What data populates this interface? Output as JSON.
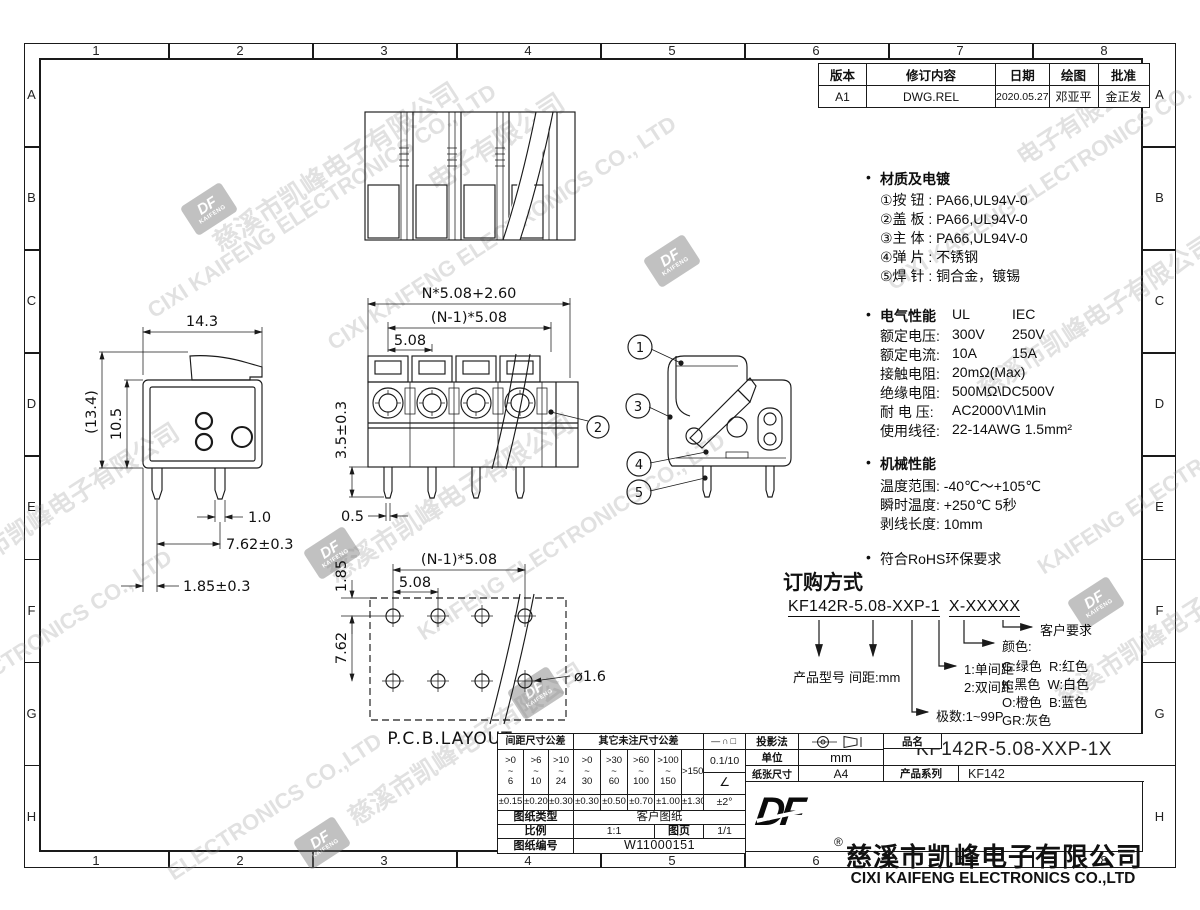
{
  "frame": {
    "col_labels": [
      "1",
      "2",
      "3",
      "4",
      "5",
      "6",
      "7",
      "8"
    ],
    "row_labels": [
      "A",
      "B",
      "C",
      "D",
      "E",
      "F",
      "G",
      "H"
    ]
  },
  "revision_table": {
    "headers": [
      "版本",
      "修订内容",
      "日期",
      "绘图",
      "批准"
    ],
    "row": [
      "A1",
      "DWG.REL",
      "2020.05.27",
      "邓亚平",
      "金正发"
    ]
  },
  "specs": {
    "bullet": "•",
    "materials": {
      "title": "材质及电镀",
      "items": [
        "①按 钮 : PA66,UL94V-0",
        "②盖 板 : PA66,UL94V-0",
        "③主 体 : PA66,UL94V-0",
        "④弹 片 : 不锈钢",
        "⑤焊 针 : 铜合金，镀锡"
      ]
    },
    "electrical": {
      "title": "电气性能",
      "col1": "UL",
      "col2": "IEC",
      "rows": [
        {
          "label": "额定电压:",
          "a": "300V",
          "b": "250V"
        },
        {
          "label": "额定电流:",
          "a": "10A",
          "b": "15A"
        },
        {
          "label": "接触电阻:",
          "a": "20mΩ(Max)",
          "b": ""
        },
        {
          "label": "绝缘电阻:",
          "a": "500MΩ\\DC500V",
          "b": ""
        },
        {
          "label": "耐 电 压:",
          "a": "AC2000V\\1Min",
          "b": ""
        },
        {
          "label": "使用线径:",
          "a": "22-14AWG 1.5mm²",
          "b": ""
        }
      ]
    },
    "mechanical": {
      "title": "机械性能",
      "items": [
        "温度范围: -40℃～+105℃",
        "瞬时温度: +250℃ 5秒",
        "剥线长度: 10mm"
      ]
    },
    "rohs": "符合RoHS环保要求"
  },
  "ordering": {
    "title": "订购方式",
    "code_left": "KF142R-5.08-XXP-1",
    "code_right": "X-XXXXX",
    "labels": {
      "model": "产品型号",
      "pitch": "间距:mm",
      "poles": "极数:1~99P",
      "row1": "1:单间距",
      "row2": "2:双间距",
      "color_title": "颜色:",
      "colors": [
        "G:绿色  R:红色",
        "K:黑色  W:白色",
        "O:橙色  B:蓝色",
        "GR:灰色"
      ],
      "customer": "客户要求"
    }
  },
  "views": {
    "side": {
      "dims": {
        "width": "14.3",
        "overall_height": "(13.4)",
        "body_height": "10.5",
        "pin_width": "1.0",
        "pin_pitch": "7.62±0.3",
        "pin_offset": "1.85±0.3"
      }
    },
    "front": {
      "dims": {
        "total": "N*5.08+2.60",
        "span": "(N-1)*5.08",
        "pitch": "5.08",
        "pin_len": "3.5±0.3",
        "pin_thk": "0.5"
      },
      "callout": "2"
    },
    "section": {
      "callouts": [
        "1",
        "3",
        "4",
        "5"
      ]
    },
    "pcb": {
      "dims": {
        "span": "(N-1)*5.08",
        "pitch": "5.08",
        "edge": "1.85",
        "row": "7.62",
        "hole": "ø1.6"
      },
      "label": "P.C.B.LAYOUT"
    }
  },
  "tol_table": {
    "pitch_header": "间距尺寸公差",
    "other_header": "其它未注尺寸公差",
    "pitch_ranges": [
      ">0\n~\n6",
      ">6\n~\n10",
      ">10\n~\n24"
    ],
    "other_ranges": [
      ">0\n~\n30",
      ">30\n~\n60",
      ">60\n~\n100",
      ">100\n~\n150"
    ],
    "last_range": ">150",
    "pitch_tols": [
      "±0.15",
      "±0.20",
      "±0.30"
    ],
    "other_tols": [
      "±0.30",
      "±0.50",
      "±0.70",
      "±1.00"
    ],
    "last_tol": "±1.30",
    "geo_symbols": "—∩□",
    "flat_tol": "0.1/10",
    "angle_symbol": "∠",
    "angle_tol": "±2°",
    "doc_type_label": "图纸类型",
    "doc_type": "客户图纸",
    "scale_label": "比例",
    "scale": "1:1",
    "page_label": "图页",
    "page": "1/1",
    "number_label": "图纸编号",
    "number": "W11000151"
  },
  "title_block": {
    "projection_label": "投影法",
    "unit_label": "单位",
    "unit": "mm",
    "paper_label": "纸张尺寸",
    "paper": "A4",
    "name_label": "品名",
    "part_number": "KF142R-5.08-XXP-1X",
    "series_label": "产品系列",
    "series": "KF142",
    "logo": "DF",
    "reg": "®",
    "company_cn": "慈溪市凯峰电子有限公司",
    "company_en": "CIXI KAIFENG ELECTRONICS CO.,LTD"
  },
  "logo_mark": {
    "top": "DF",
    "bottom": "KAIFENG"
  },
  "colors": {
    "background": "#ffffff",
    "line": "#1a1a1a",
    "watermark": "#8f8f8f"
  },
  "watermarks": [
    {
      "kind": "text",
      "text": "慈溪市凯峰电子有限公司",
      "x": 215,
      "y": 225,
      "size": 26
    },
    {
      "kind": "text",
      "text": "CIXI KAIFENG ELECTRONICS CO., LTD",
      "x": 150,
      "y": 300,
      "size": 22
    },
    {
      "kind": "text",
      "text": "电子有限公司",
      "x": 430,
      "y": 165,
      "size": 26
    },
    {
      "kind": "text",
      "text": "CIXI KAIFENG ELECTRONICS CO., LTD",
      "x": 330,
      "y": 332,
      "size": 22
    },
    {
      "kind": "text",
      "text": "慈溪市凯峰电子有限公司",
      "x": 330,
      "y": 556,
      "size": 26
    },
    {
      "kind": "text",
      "text": "KAIFENG ELECTRONICS CO., LTD",
      "x": 420,
      "y": 622,
      "size": 22
    },
    {
      "kind": "text",
      "text": "慈溪市凯峰电子有限公司",
      "x": -55,
      "y": 560,
      "size": 25
    },
    {
      "kind": "text",
      "text": "ELECTRONICS CO., LTD",
      "x": -45,
      "y": 682,
      "size": 22
    },
    {
      "kind": "text",
      "text": "慈溪市凯峰电子有限公司",
      "x": 350,
      "y": 800,
      "size": 25
    },
    {
      "kind": "text",
      "text": "ELECTRONICS CO.,LTD",
      "x": 170,
      "y": 862,
      "size": 22
    },
    {
      "kind": "text",
      "text": "CIXI KAIFENG ELECTRONICS CO.",
      "x": 890,
      "y": 272,
      "size": 22
    },
    {
      "kind": "text",
      "text": "慈溪市凯峰电子有限公司",
      "x": 980,
      "y": 372,
      "size": 25
    },
    {
      "kind": "text",
      "text": "KAIFENG ELECTRONICS",
      "x": 1040,
      "y": 556,
      "size": 22
    },
    {
      "kind": "text",
      "text": "慈溪市凯峰电子",
      "x": 1058,
      "y": 680,
      "size": 25
    },
    {
      "kind": "text",
      "text": "电子有限公司",
      "x": 1018,
      "y": 140,
      "size": 24
    },
    {
      "kind": "logo",
      "x": 185,
      "y": 192
    },
    {
      "kind": "logo",
      "x": 648,
      "y": 244
    },
    {
      "kind": "logo",
      "x": 308,
      "y": 536
    },
    {
      "kind": "logo",
      "x": 512,
      "y": 676
    },
    {
      "kind": "logo",
      "x": 298,
      "y": 826
    },
    {
      "kind": "logo",
      "x": 1072,
      "y": 586
    }
  ]
}
